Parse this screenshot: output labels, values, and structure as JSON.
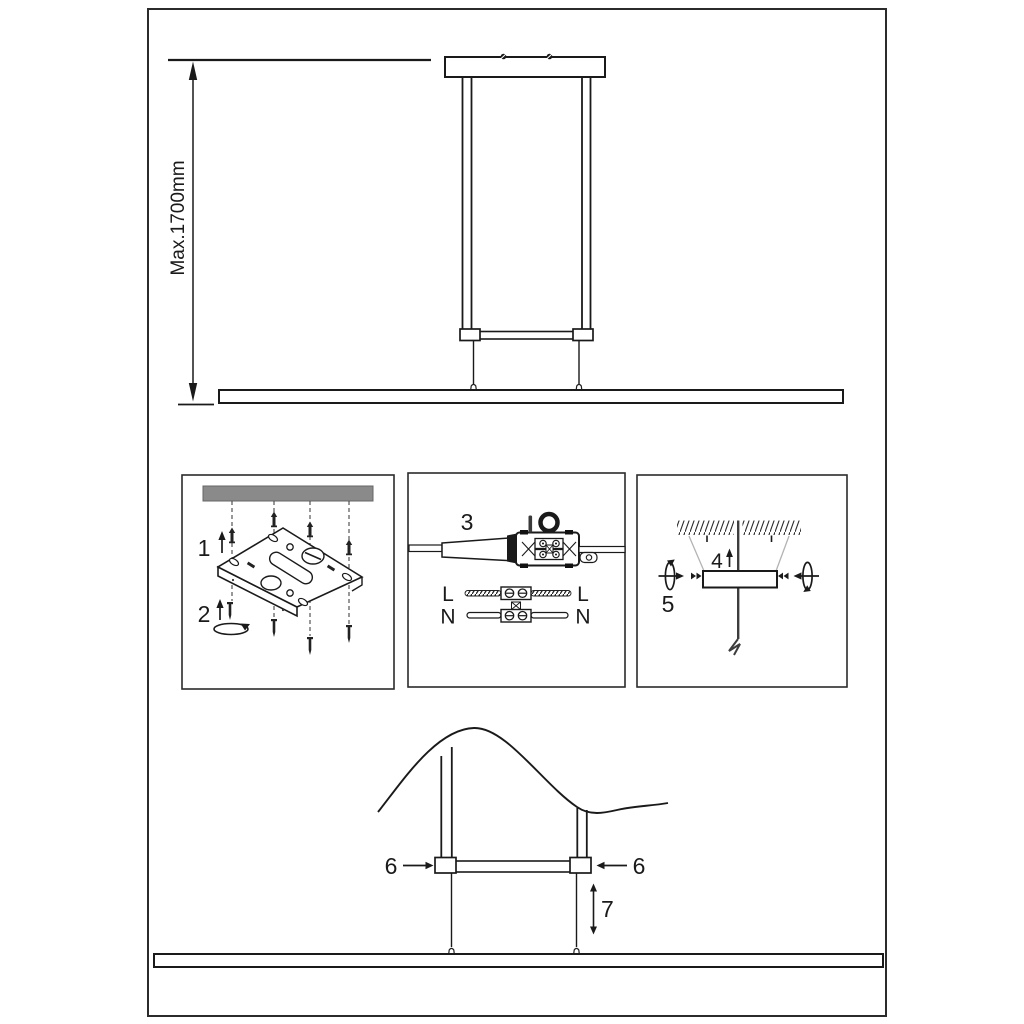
{
  "diagram": {
    "dimension": {
      "max_height_label": "Max.1700mm"
    },
    "steps": {
      "s1": "1",
      "s2": "2",
      "s3": "3",
      "s4": "4",
      "s5": "5",
      "s6": "6",
      "s7": "7"
    },
    "wiring": {
      "live": "L",
      "neutral": "N"
    },
    "colors": {
      "ink": "#1a1a1a",
      "ceiling_gray": "#8a8a8a",
      "guide_gray": "#b3b3b3"
    }
  }
}
